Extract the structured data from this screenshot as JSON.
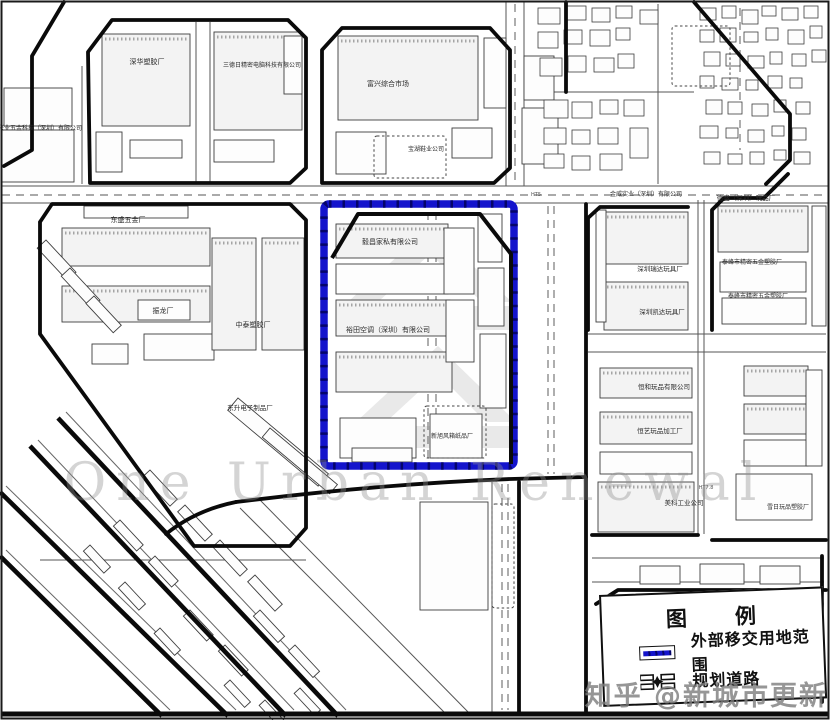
{
  "legend": {
    "title": "图　　例",
    "items": [
      {
        "id": "transfer-area",
        "label": "外部移交用地范围"
      },
      {
        "id": "planned-road",
        "label": "规划道路"
      }
    ]
  },
  "watermarks": {
    "center": "One Urban Renewal",
    "brand": "知乎 @新城市更新"
  },
  "map": {
    "width": 830,
    "height": 720,
    "highlight_color": "#1414cc",
    "highlight_rect": {
      "x": 324,
      "y": 204,
      "w": 190,
      "h": 262
    },
    "inner_road": "M332,258 L358,214 L480,214 L511,254 L511,464",
    "labels": [
      {
        "t": "深华塑胶厂",
        "x": 147,
        "y": 64,
        "s": 7
      },
      {
        "t": "三德日精密电脑科技有限公司",
        "x": 262,
        "y": 67,
        "s": 6
      },
      {
        "t": "富兴综合市场",
        "x": 388,
        "y": 86,
        "s": 7
      },
      {
        "t": "宝湖鞋业公司",
        "x": 426,
        "y": 151,
        "s": 6
      },
      {
        "t": "兴业五金科技（深圳）有限公司",
        "x": 40,
        "y": 130,
        "s": 6
      },
      {
        "t": "东盛五金厂",
        "x": 128,
        "y": 222,
        "s": 7
      },
      {
        "t": "振龙厂",
        "x": 163,
        "y": 313,
        "s": 7
      },
      {
        "t": "中泰塑胶厂",
        "x": 253,
        "y": 327,
        "s": 7
      },
      {
        "t": "东升电子制品厂",
        "x": 250,
        "y": 410,
        "s": 6.5
      },
      {
        "t": "毅昌家私有限公司",
        "x": 390,
        "y": 244,
        "s": 7
      },
      {
        "t": "裕田空调（深圳）有限公司",
        "x": 388,
        "y": 332,
        "s": 7
      },
      {
        "t": "新旭风箱纸品厂",
        "x": 452,
        "y": 438,
        "s": 6
      },
      {
        "t": "金威实业（深圳）有限公司",
        "x": 646,
        "y": 196,
        "s": 6
      },
      {
        "t": "德盛（深圳）玩品厂",
        "x": 746,
        "y": 200,
        "s": 6.5
      },
      {
        "t": "深圳瑞达玩具厂",
        "x": 660,
        "y": 271,
        "s": 6.5
      },
      {
        "t": "泰峰市精密五金塑胶厂",
        "x": 752,
        "y": 264,
        "s": 6
      },
      {
        "t": "深圳凯达玩具厂",
        "x": 662,
        "y": 314,
        "s": 6.5
      },
      {
        "t": "泰峰市精密五金塑胶厂",
        "x": 758,
        "y": 298,
        "s": 6
      },
      {
        "t": "恒和玩品有限公司",
        "x": 664,
        "y": 389,
        "s": 6.5
      },
      {
        "t": "恒艺玩品加工厂",
        "x": 660,
        "y": 433,
        "s": 6.5
      },
      {
        "t": "美科工业公司",
        "x": 684,
        "y": 505,
        "s": 6.5
      },
      {
        "t": "雪日玩品塑胶厂",
        "x": 788,
        "y": 509,
        "s": 6
      }
    ],
    "tiny_labels": [
      {
        "t": "HT5",
        "x": 536,
        "y": 196
      },
      {
        "t": "HT7.8",
        "x": 706,
        "y": 489
      }
    ],
    "buildings": [
      [
        102,
        34,
        88,
        92,
        1
      ],
      [
        96,
        132,
        26,
        40,
        0
      ],
      [
        130,
        140,
        52,
        18,
        0
      ],
      [
        214,
        32,
        88,
        98,
        1
      ],
      [
        214,
        140,
        60,
        22,
        0
      ],
      [
        284,
        36,
        18,
        58,
        0
      ],
      [
        338,
        36,
        140,
        84,
        1
      ],
      [
        484,
        38,
        22,
        70,
        0
      ],
      [
        336,
        132,
        50,
        42,
        0
      ],
      [
        452,
        128,
        40,
        30,
        0
      ],
      [
        4,
        88,
        68,
        38,
        0
      ],
      [
        2,
        130,
        72,
        52,
        0
      ],
      [
        84,
        206,
        104,
        12,
        0
      ],
      [
        62,
        228,
        148,
        38,
        1
      ],
      [
        62,
        286,
        148,
        36,
        1
      ],
      [
        138,
        300,
        52,
        20,
        0
      ],
      [
        144,
        334,
        70,
        26,
        0
      ],
      [
        212,
        238,
        44,
        112,
        1
      ],
      [
        262,
        238,
        42,
        112,
        1
      ],
      [
        92,
        344,
        36,
        20,
        0
      ],
      [
        336,
        224,
        112,
        34,
        1
      ],
      [
        336,
        264,
        112,
        30,
        0
      ],
      [
        336,
        300,
        114,
        36,
        1
      ],
      [
        336,
        352,
        116,
        40,
        1
      ],
      [
        340,
        418,
        76,
        40,
        0
      ],
      [
        430,
        414,
        52,
        44,
        0
      ],
      [
        444,
        228,
        30,
        66,
        0
      ],
      [
        446,
        300,
        28,
        62,
        0
      ],
      [
        478,
        214,
        24,
        48,
        0
      ],
      [
        478,
        268,
        26,
        58,
        0
      ],
      [
        480,
        334,
        26,
        74,
        0
      ],
      [
        352,
        448,
        60,
        14,
        0
      ],
      [
        604,
        212,
        84,
        52,
        1
      ],
      [
        604,
        282,
        84,
        48,
        1
      ],
      [
        596,
        210,
        10,
        112,
        0
      ],
      [
        718,
        206,
        90,
        46,
        1
      ],
      [
        720,
        262,
        86,
        30,
        0
      ],
      [
        722,
        298,
        84,
        26,
        0
      ],
      [
        812,
        206,
        14,
        120,
        0
      ],
      [
        600,
        368,
        92,
        30,
        1
      ],
      [
        600,
        412,
        92,
        32,
        1
      ],
      [
        600,
        452,
        92,
        22,
        0
      ],
      [
        598,
        482,
        96,
        50,
        1
      ],
      [
        744,
        366,
        64,
        30,
        1
      ],
      [
        744,
        404,
        64,
        30,
        1
      ],
      [
        744,
        440,
        64,
        26,
        0
      ],
      [
        736,
        474,
        76,
        46,
        0
      ],
      [
        806,
        370,
        16,
        96,
        0
      ],
      [
        420,
        502,
        68,
        108,
        0
      ],
      [
        640,
        566,
        40,
        18,
        0
      ],
      [
        700,
        564,
        44,
        20,
        0
      ],
      [
        760,
        566,
        40,
        18,
        0
      ],
      [
        522,
        108,
        36,
        56,
        0
      ],
      [
        524,
        56,
        30,
        44,
        0
      ]
    ],
    "village": [
      [
        538,
        8,
        22,
        16
      ],
      [
        566,
        6,
        20,
        14
      ],
      [
        592,
        8,
        18,
        14
      ],
      [
        616,
        6,
        16,
        12
      ],
      [
        640,
        10,
        18,
        14
      ],
      [
        538,
        32,
        20,
        16
      ],
      [
        564,
        30,
        18,
        14
      ],
      [
        590,
        30,
        20,
        16
      ],
      [
        616,
        28,
        14,
        12
      ],
      [
        540,
        58,
        22,
        18
      ],
      [
        568,
        56,
        18,
        16
      ],
      [
        594,
        58,
        20,
        14
      ],
      [
        618,
        54,
        16,
        14
      ],
      [
        544,
        100,
        24,
        18
      ],
      [
        572,
        102,
        20,
        16
      ],
      [
        600,
        100,
        18,
        14
      ],
      [
        624,
        100,
        20,
        16
      ],
      [
        544,
        128,
        22,
        16
      ],
      [
        572,
        130,
        18,
        14
      ],
      [
        598,
        128,
        20,
        16
      ],
      [
        630,
        128,
        18,
        30
      ],
      [
        544,
        154,
        20,
        14
      ],
      [
        572,
        156,
        18,
        14
      ],
      [
        600,
        154,
        22,
        16
      ],
      [
        700,
        8,
        16,
        12
      ],
      [
        722,
        6,
        14,
        12
      ],
      [
        742,
        10,
        16,
        14
      ],
      [
        762,
        6,
        14,
        10
      ],
      [
        782,
        8,
        16,
        12
      ],
      [
        804,
        6,
        14,
        12
      ],
      [
        700,
        30,
        14,
        12
      ],
      [
        720,
        28,
        16,
        14
      ],
      [
        744,
        32,
        14,
        10
      ],
      [
        766,
        28,
        12,
        12
      ],
      [
        788,
        30,
        16,
        14
      ],
      [
        810,
        26,
        12,
        12
      ],
      [
        704,
        52,
        16,
        14
      ],
      [
        726,
        54,
        14,
        12
      ],
      [
        748,
        56,
        16,
        12
      ],
      [
        770,
        52,
        12,
        12
      ],
      [
        792,
        54,
        14,
        12
      ],
      [
        812,
        50,
        14,
        12
      ],
      [
        700,
        76,
        14,
        12
      ],
      [
        722,
        78,
        16,
        12
      ],
      [
        746,
        80,
        12,
        10
      ],
      [
        768,
        76,
        14,
        12
      ],
      [
        790,
        78,
        12,
        10
      ],
      [
        706,
        100,
        16,
        14
      ],
      [
        728,
        102,
        14,
        12
      ],
      [
        752,
        104,
        16,
        12
      ],
      [
        774,
        100,
        12,
        12
      ],
      [
        796,
        102,
        14,
        12
      ],
      [
        700,
        126,
        18,
        12
      ],
      [
        726,
        128,
        12,
        10
      ],
      [
        748,
        130,
        16,
        12
      ],
      [
        772,
        126,
        12,
        10
      ],
      [
        792,
        128,
        14,
        12
      ],
      [
        704,
        152,
        16,
        12
      ],
      [
        728,
        154,
        14,
        10
      ],
      [
        750,
        152,
        14,
        12
      ],
      [
        774,
        150,
        12,
        10
      ],
      [
        794,
        152,
        16,
        12
      ]
    ],
    "rot_buildings": [
      [
        46,
        240,
        44,
        12,
        47
      ],
      [
        70,
        268,
        44,
        12,
        47
      ],
      [
        94,
        296,
        40,
        11,
        47
      ],
      [
        238,
        398,
        118,
        16,
        40
      ],
      [
        270,
        428,
        88,
        12,
        40
      ],
      [
        150,
        470,
        40,
        10,
        47
      ],
      [
        185,
        505,
        40,
        10,
        47
      ],
      [
        220,
        540,
        40,
        10,
        47
      ],
      [
        255,
        575,
        40,
        10,
        47
      ],
      [
        120,
        520,
        34,
        9,
        47
      ],
      [
        155,
        556,
        34,
        9,
        47
      ],
      [
        90,
        545,
        30,
        9,
        47
      ],
      [
        125,
        582,
        30,
        9,
        47
      ],
      [
        190,
        610,
        34,
        9,
        47
      ],
      [
        225,
        645,
        34,
        9,
        47
      ],
      [
        160,
        628,
        30,
        8,
        47
      ],
      [
        260,
        610,
        36,
        9,
        47
      ],
      [
        295,
        645,
        36,
        9,
        47
      ],
      [
        230,
        680,
        30,
        8,
        47
      ],
      [
        300,
        688,
        30,
        8,
        47
      ],
      [
        265,
        700,
        28,
        8,
        47
      ]
    ],
    "dashed_rects": [
      [
        672,
        26,
        58,
        60
      ],
      [
        374,
        136,
        72,
        42
      ],
      [
        424,
        406,
        62,
        52
      ],
      [
        492,
        504,
        22,
        104
      ]
    ],
    "gray_shapes": [
      "M348,302 L430,226 L512,302 L482,302 L430,254 L378,302 Z",
      "M356,422 L438,346 L516,422 L486,422 L438,374 L386,422 Z",
      "M348,306 L512,306 L512,330 L348,330 Z",
      "M356,426 L516,426 L516,448 L356,448 Z"
    ],
    "roads": {
      "thick": [
        "M90,183 L88,52 L112,20 L288,20 L306,38 L306,168 L290,183 L90,183",
        "M322,183 L322,50 L342,28 L490,28 L510,50 L510,168 L494,183 L322,183",
        "M64,2 L32,56 L32,150 L4,166",
        "M40,222 L52,204 L290,204 L306,220 L306,528 L290,546 L194,546 L40,334 L40,222",
        "M236,502 Q380,484 510,479 L586,477",
        "M519,482 L519,714",
        "M586,204 L586,714",
        "M588,330 L588,218 L600,207 L688,207",
        "M712,330 L712,210 L724,198 L764,198 L788,174",
        "M694,2 L790,114 L790,160 L766,184",
        "M566,2 L566,92",
        "M592,535 L698,535",
        "M712,540 L826,540",
        "M822,556 L822,702",
        "M596,604 L618,590 L826,590",
        "M236,502 Q196,510 166,534"
      ],
      "rail": [
        "M58,418 L338,716",
        "M30,446 L286,716",
        "M0,492 L228,716",
        "M0,556 L162,716"
      ],
      "rail_thin": [
        "M66,412 L346,710",
        "M38,440 L294,710",
        "M6,486 L236,710",
        "M6,550 L170,710"
      ],
      "thin": [
        "M2,186 L828,186",
        "M2,203 L828,203",
        "M506,2 L506,186",
        "M524,2 L524,186",
        "M588,334 L826,334",
        "M588,352 L826,352",
        "M592,558 L824,558",
        "M592,582 L824,582",
        "M698,200 L698,534",
        "M704,200 L704,534",
        "M82,66 L82,184",
        "M196,22 L196,182",
        "M210,22 L210,182",
        "M40,560 L306,560",
        "M658,4 L658,184",
        "M534,92 L694,92",
        "M240,508 L448,716",
        "M260,500 L472,716",
        "M492,482 L492,712"
      ],
      "dashed": [
        "M2,195 L828,195",
        "M515,4 L515,184",
        "M548,206 L548,474",
        "M554,206 L554,474",
        "M740,8 L740,150",
        "M428,212 L428,460",
        "M436,212 L436,460",
        "M502,484 L502,710",
        "M508,484 L508,710"
      ]
    }
  }
}
